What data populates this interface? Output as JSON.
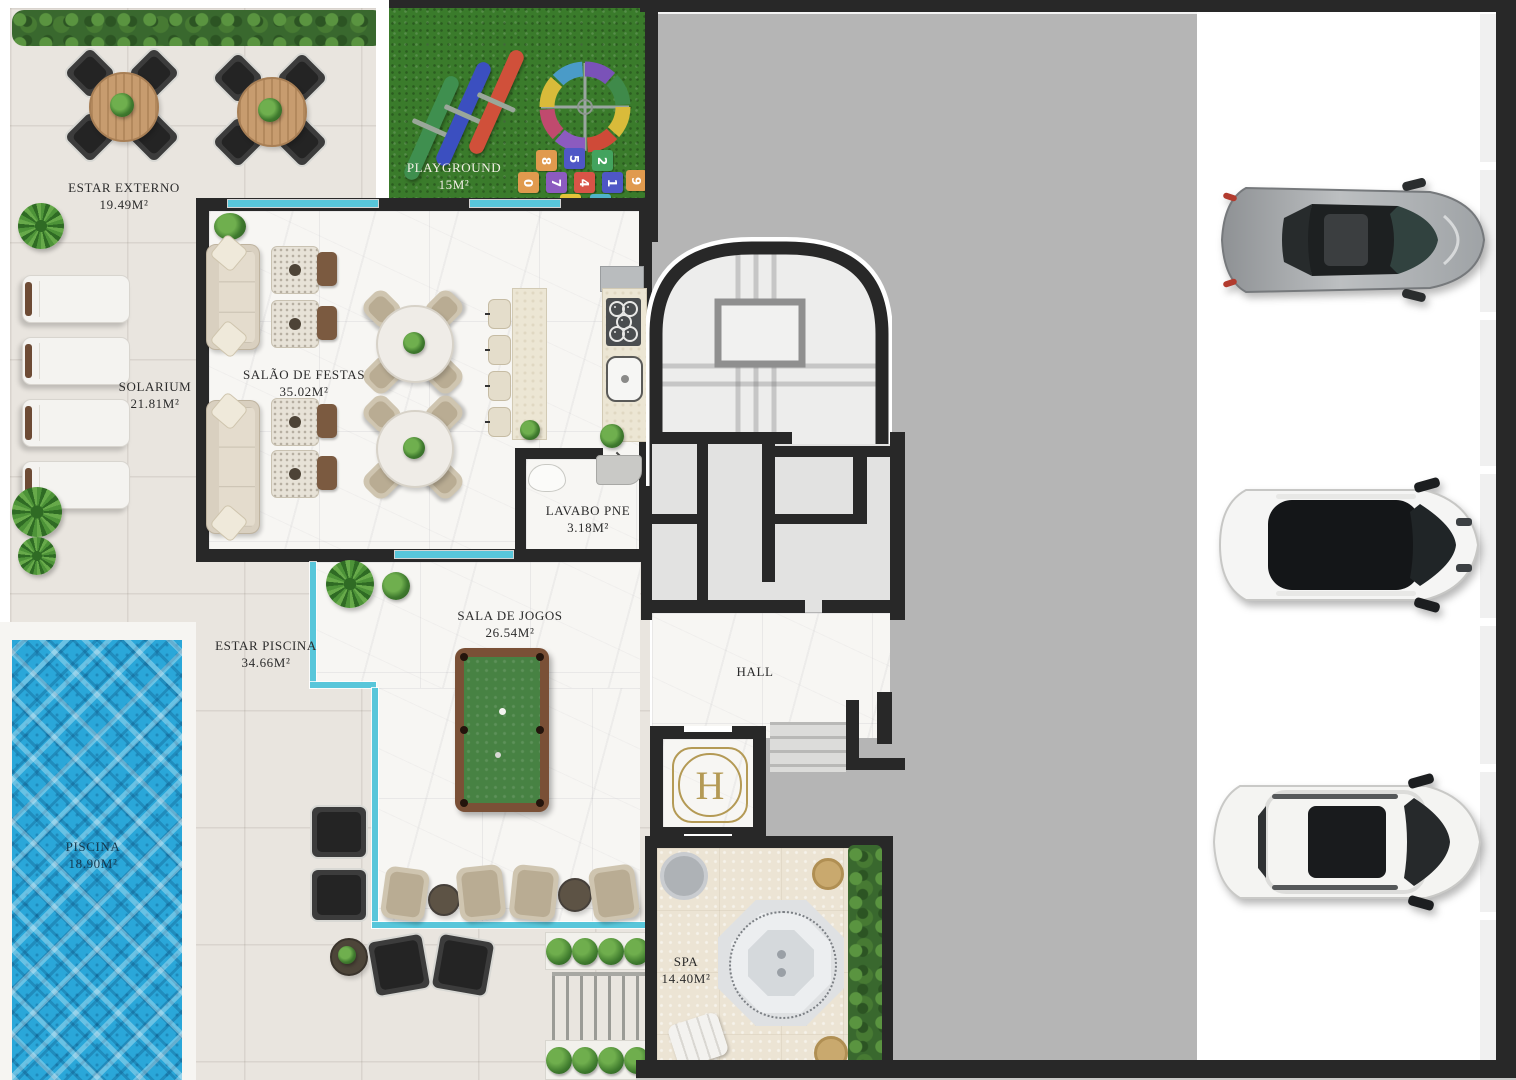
{
  "plan_title": "Pavimento de lazer - planta humanizada",
  "rooms": {
    "estar_externo": {
      "name": "ESTAR EXTERNO",
      "area": "19.49M²"
    },
    "playground": {
      "name": "PLAYGROUND",
      "area": "15M²"
    },
    "salao_de_festas": {
      "name": "SALÃO DE FESTAS",
      "area": "35.02M²"
    },
    "solarium": {
      "name": "SOLARIUM",
      "area": "21.81M²"
    },
    "lavabo_pne": {
      "name": "LAVABO PNE",
      "area": "3.18M²"
    },
    "sala_de_jogos": {
      "name": "SALA DE JOGOS",
      "area": "26.54M²"
    },
    "estar_piscina": {
      "name": "ESTAR PISCINA",
      "area": "34.66M²"
    },
    "hall": {
      "name": "HALL"
    },
    "piscina": {
      "name": "PISCINA",
      "area": "18.90M²"
    },
    "spa": {
      "name": "SPA",
      "area": "14.40M²"
    }
  },
  "elevator": {
    "logo": "H"
  },
  "playground_numbers": [
    "8",
    "5",
    "2",
    "0",
    "7",
    "4",
    "1",
    "9",
    "6",
    "3"
  ],
  "parking": {
    "total_spaces": 7,
    "spaces": [
      {
        "index": 1,
        "car": null
      },
      {
        "index": 2,
        "car": "silver sedan"
      },
      {
        "index": 3,
        "car": null
      },
      {
        "index": 4,
        "car": "white SUV black roof"
      },
      {
        "index": 5,
        "car": null
      },
      {
        "index": 6,
        "car": "white SUV panoramic roof"
      },
      {
        "index": 7,
        "car": null
      }
    ]
  },
  "colors": {
    "wall": "#282828",
    "tile": "#e9e5df",
    "marble": "#f7f6f3",
    "spafloor": "#ece4d4",
    "grass": "#3a7b2b",
    "pool": "#2aa7d9",
    "parking": "#b5b5b5",
    "glassc": "#58c6da",
    "gold": "#b49a55",
    "labelc": "#2b2b2b",
    "carsilver": "#a8abae",
    "carwhite": "#f5f5f3"
  }
}
